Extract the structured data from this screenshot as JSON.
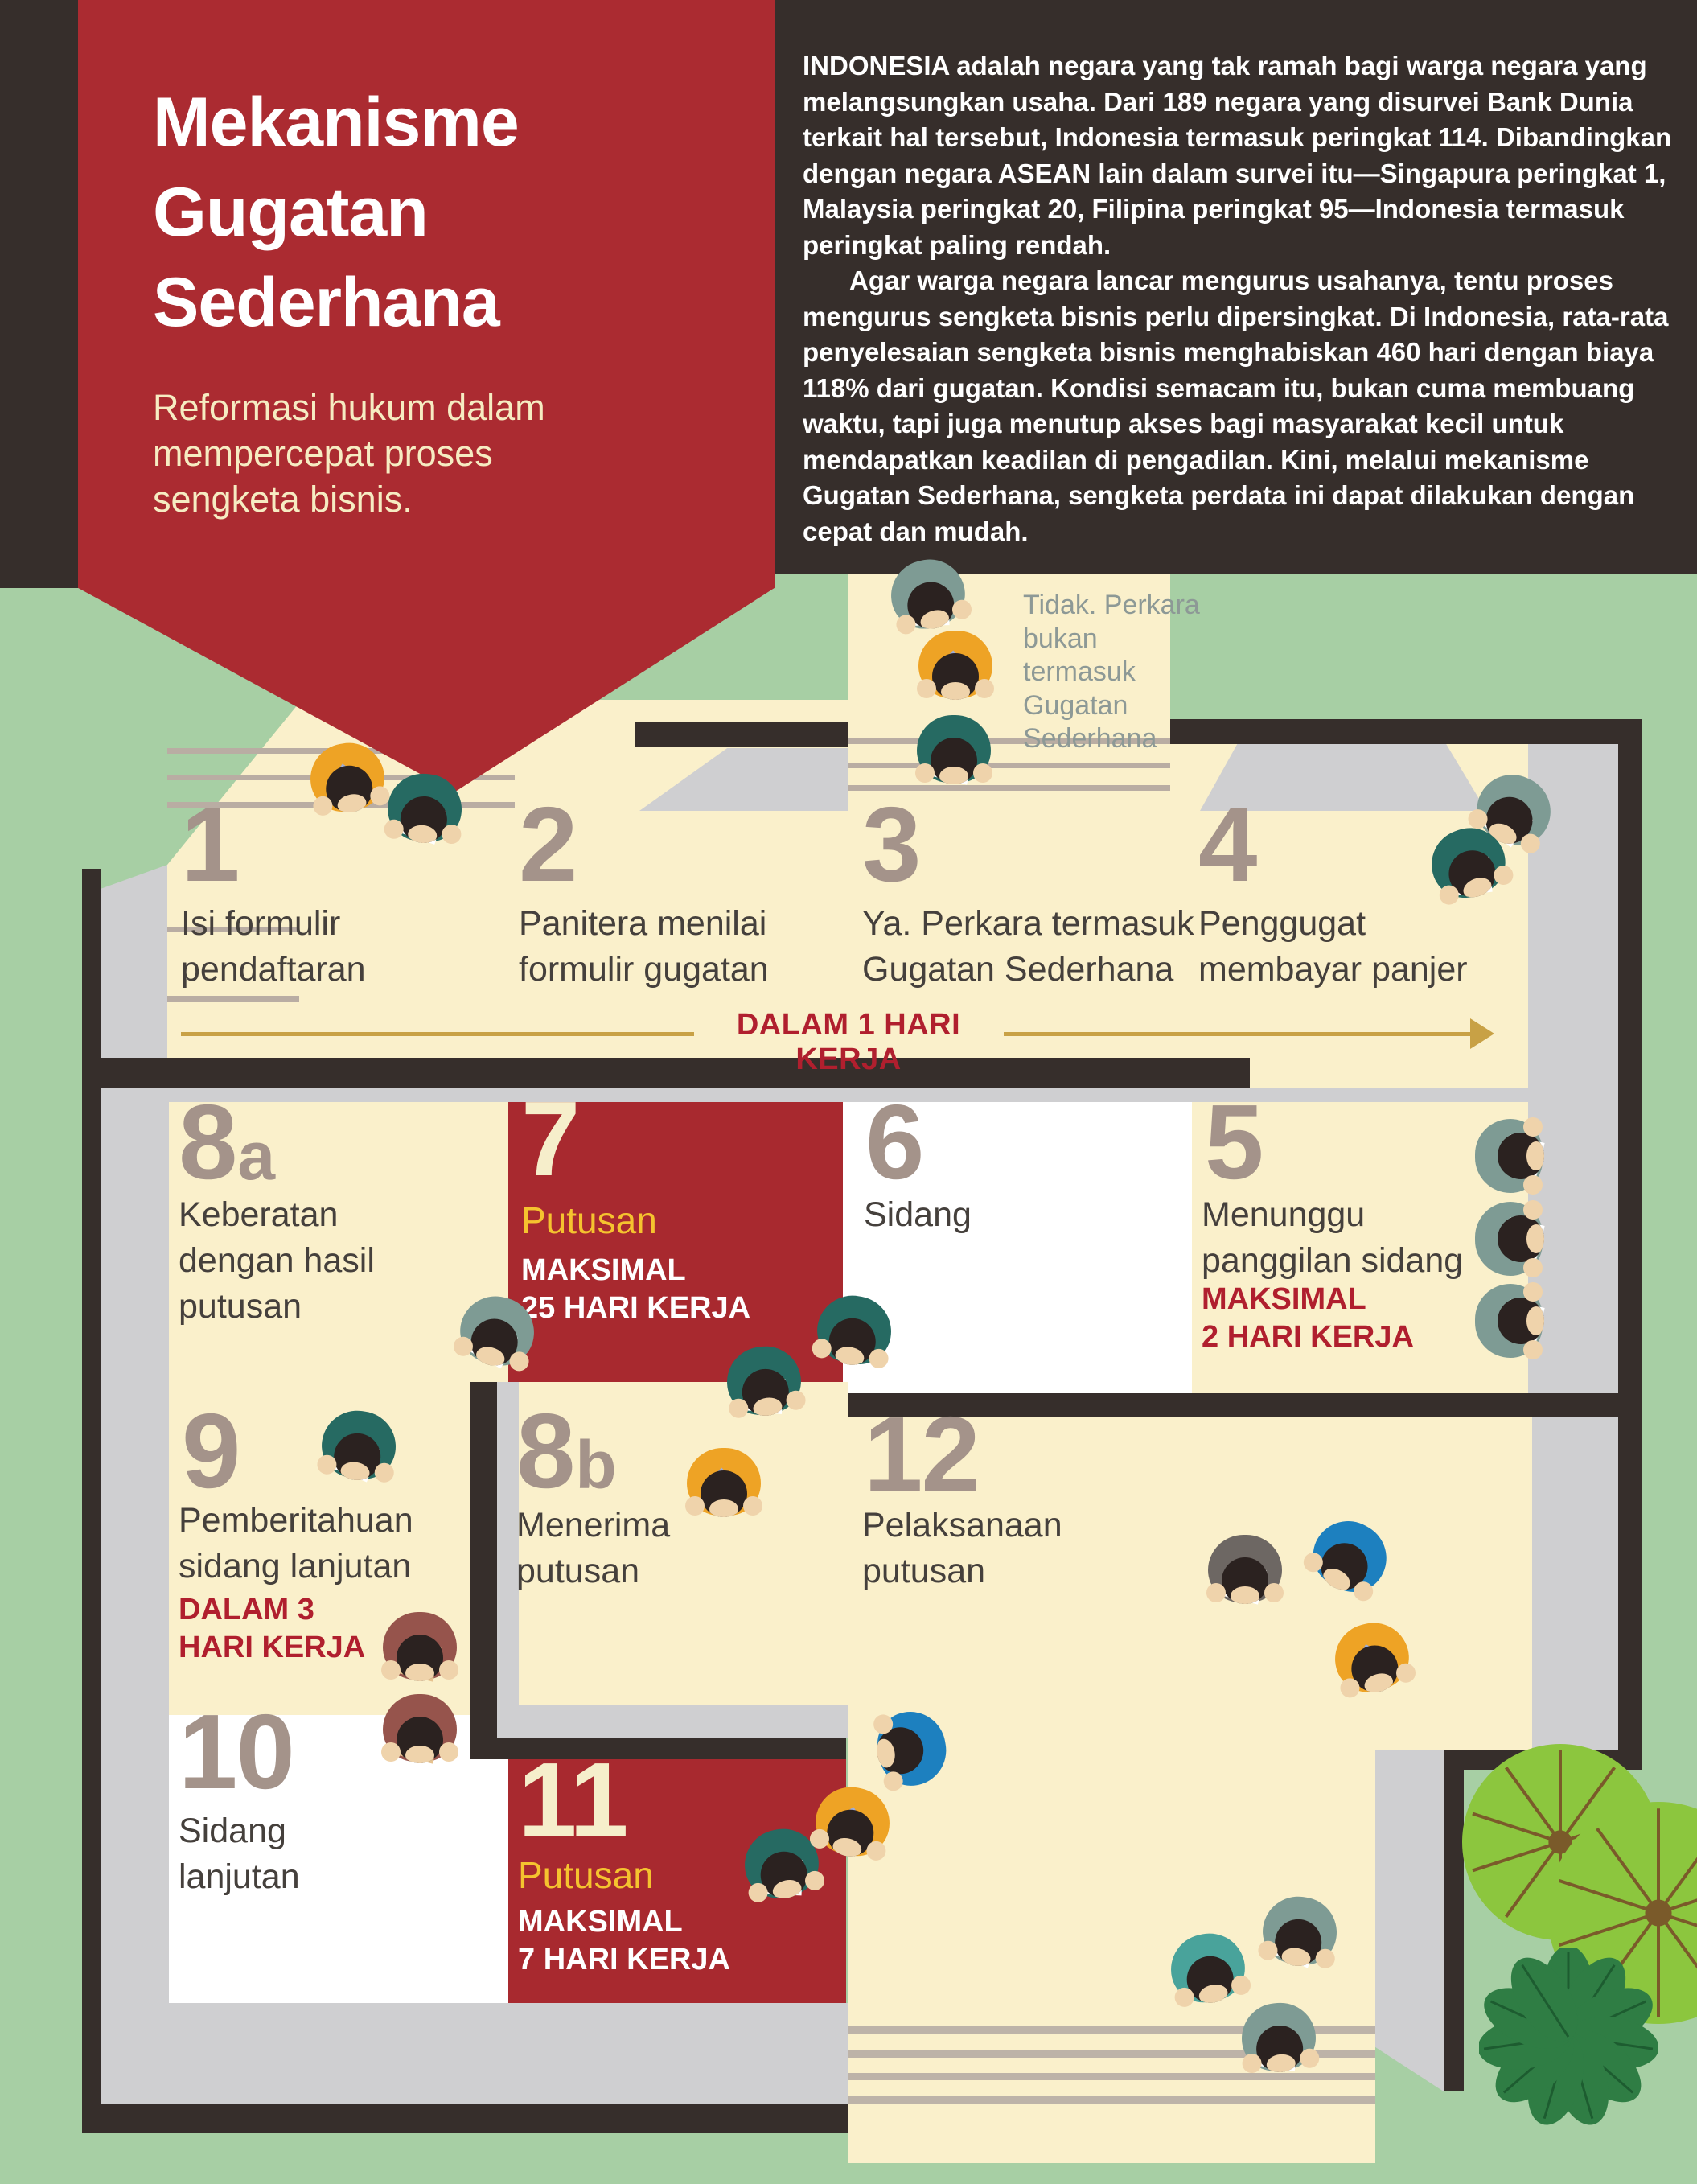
{
  "title": {
    "lines": [
      "Mekanisme",
      "Gugatan",
      "Sederhana"
    ],
    "subtitle_lines": [
      "Reformasi hukum dalam",
      "mempercepat proses",
      "sengketa bisnis."
    ]
  },
  "intro": {
    "p1": "INDONESIA adalah negara yang tak ramah bagi warga negara yang melangsungkan usaha. Dari 189 negara yang disurvei Bank Dunia terkait hal tersebut, Indonesia termasuk peringkat 114. Dibandingkan dengan negara ASEAN lain dalam survei itu—Singapura peringkat 1, Malaysia peringkat 20, Filipina peringkat 95—Indonesia termasuk peringkat paling rendah.",
    "p2": "Agar warga negara lancar mengurus usahanya, tentu proses mengurus sengketa bisnis perlu dipersingkat. Di Indonesia, rata-rata penyelesaian sengketa bisnis menghabiskan 460 hari dengan biaya 118% dari gugatan. Kondisi semacam itu, bukan cuma membuang waktu, tapi juga menutup akses bagi masyarakat kecil untuk mendapatkan keadilan di pengadilan. Kini, melalui mekanisme Gugatan Sederhana, sengketa perdata ini dapat dilakukan dengan cepat dan mudah."
  },
  "decision_note": {
    "lines": [
      "Tidak. Perkara",
      "bukan",
      "termasuk",
      "Gugatan",
      "Sederhana"
    ]
  },
  "timeline": {
    "label": "DALAM 1 HARI KERJA"
  },
  "zones": [
    {
      "id": "step-1",
      "number": "1",
      "number_sub": "",
      "title_lines": [
        "Isi formulir",
        "pendaftaran"
      ],
      "label": "",
      "note_lines": [],
      "note_style": ""
    },
    {
      "id": "step-2",
      "number": "2",
      "number_sub": "",
      "title_lines": [
        "Panitera menilai",
        "formulir gugatan"
      ],
      "label": "",
      "note_lines": [],
      "note_style": ""
    },
    {
      "id": "step-3",
      "number": "3",
      "number_sub": "",
      "title_lines": [
        "Ya. Perkara termasuk",
        "Gugatan Sederhana"
      ],
      "label": "",
      "note_lines": [],
      "note_style": ""
    },
    {
      "id": "step-4",
      "number": "4",
      "number_sub": "",
      "title_lines": [
        "Penggugat",
        "membayar panjer"
      ],
      "label": "",
      "note_lines": [],
      "note_style": ""
    },
    {
      "id": "step-8a",
      "number": "8",
      "number_sub": "a",
      "title_lines": [
        "Keberatan",
        "dengan hasil",
        "putusan"
      ],
      "label": "",
      "note_lines": [],
      "note_style": ""
    },
    {
      "id": "step-7",
      "number": "7",
      "number_sub": "",
      "title_lines": [],
      "label": "Putusan",
      "note_lines": [
        "MAKSIMAL",
        "25 HARI KERJA"
      ],
      "note_style": "white",
      "on_red": true
    },
    {
      "id": "step-6",
      "number": "6",
      "number_sub": "",
      "title_lines": [
        "Sidang"
      ],
      "label": "",
      "note_lines": [],
      "note_style": ""
    },
    {
      "id": "step-5",
      "number": "5",
      "number_sub": "",
      "title_lines": [
        "Menunggu",
        "panggilan sidang"
      ],
      "label": "",
      "note_lines": [
        "MAKSIMAL",
        "2 HARI KERJA"
      ],
      "note_style": "red"
    },
    {
      "id": "step-9",
      "number": "9",
      "number_sub": "",
      "title_lines": [
        "Pemberitahuan",
        "sidang lanjutan"
      ],
      "label": "",
      "note_lines": [
        "DALAM 3",
        "HARI KERJA"
      ],
      "note_style": "red"
    },
    {
      "id": "step-8b",
      "number": "8",
      "number_sub": "b",
      "title_lines": [
        "Menerima",
        "putusan"
      ],
      "label": "",
      "note_lines": [],
      "note_style": ""
    },
    {
      "id": "step-12",
      "number": "12",
      "number_sub": "",
      "title_lines": [
        "Pelaksanaan",
        "putusan"
      ],
      "label": "",
      "note_lines": [],
      "note_style": ""
    },
    {
      "id": "step-10",
      "number": "10",
      "number_sub": "",
      "title_lines": [
        "Sidang",
        "lanjutan"
      ],
      "label": "",
      "note_lines": [],
      "note_style": ""
    },
    {
      "id": "step-11",
      "number": "11",
      "number_sub": "",
      "title_lines": [],
      "label": "Putusan",
      "note_lines": [
        "MAKSIMAL",
        "7 HARI KERJA"
      ],
      "note_style": "white",
      "on_red": true
    }
  ],
  "colors": {
    "background_green": "#a7cfa4",
    "floor_cream": "#faf0cb",
    "panel_dark": "#362e2b",
    "accent_red": "#ab2b31",
    "text_red": "#b01f2e",
    "number_taupe": "#a4938a",
    "putusan_yellow": "#f5c32f",
    "timeline_gold": "#c8a145",
    "room_white": "#ffffff",
    "sidewalk_gray": "#cfcfd1"
  }
}
